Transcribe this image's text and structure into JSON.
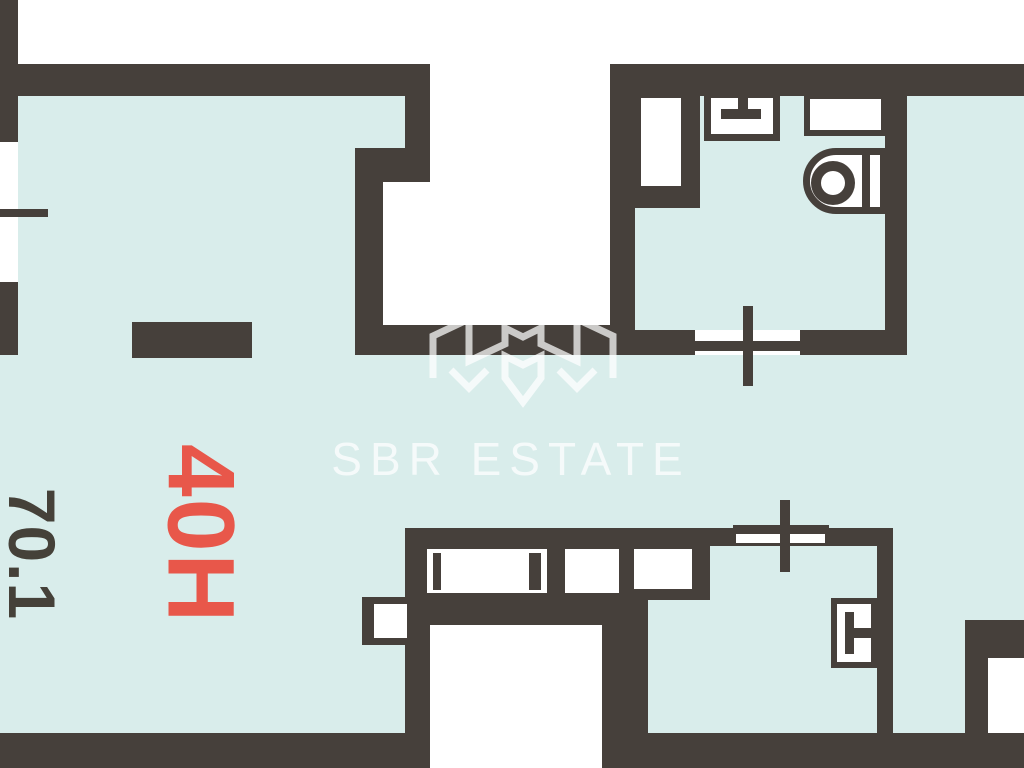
{
  "labels": {
    "unit": "40H",
    "area": "70.1"
  },
  "watermark": {
    "text": "SBR ESTATE"
  },
  "colors": {
    "wall": "#46403b",
    "floor": "#d9edeb",
    "outside": "#ffffff",
    "accent": "#e8574a",
    "area_text": "#454139",
    "watermark": "rgba(255,255,255,0.72)"
  }
}
